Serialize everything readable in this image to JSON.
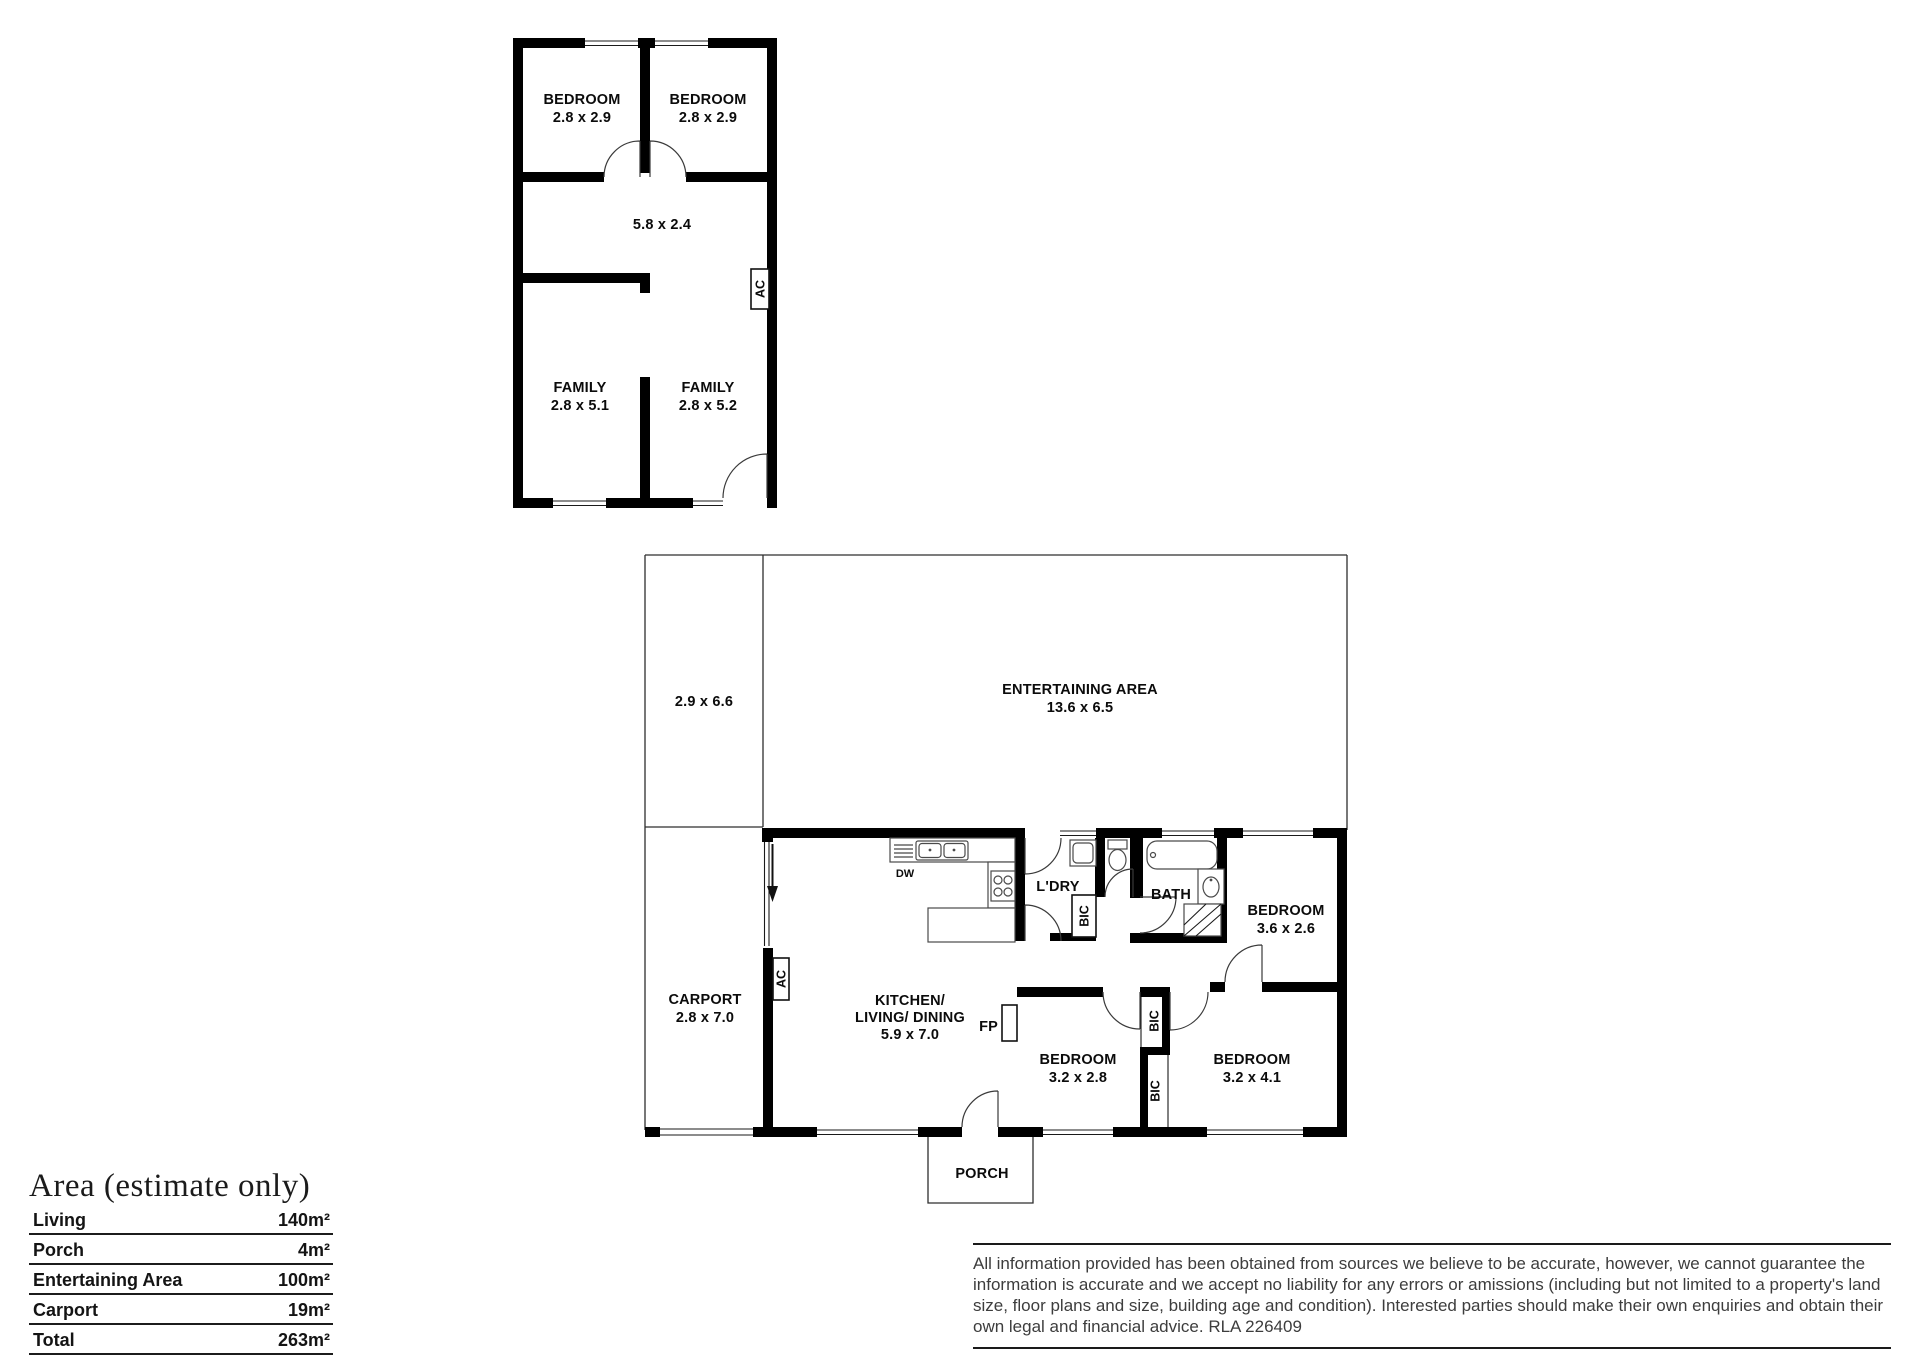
{
  "outbuilding": {
    "bedroom1": {
      "name": "BEDROOM",
      "dims": "2.8 x 2.9"
    },
    "bedroom2": {
      "name": "BEDROOM",
      "dims": "2.8 x 2.9"
    },
    "hall_dims": "5.8 x 2.4",
    "family1": {
      "name": "FAMILY",
      "dims": "2.8 x 5.1"
    },
    "family2": {
      "name": "FAMILY",
      "dims": "2.8 x 5.2"
    },
    "ac": "AC"
  },
  "house": {
    "left_area_dims": "2.9 x 6.6",
    "entertaining": {
      "name": "ENTERTAINING AREA",
      "dims": "13.6 x 6.5"
    },
    "carport": {
      "name": "CARPORT",
      "dims": "2.8 x 7.0"
    },
    "kitchen": {
      "name1": "KITCHEN/",
      "name2": "LIVING/ DINING",
      "dims": "5.9 x 7.0"
    },
    "laundry": "L'DRY",
    "bath": "BATH",
    "bedroom_top": {
      "name": "BEDROOM",
      "dims": "3.6 x 2.6"
    },
    "bedroom_mid": {
      "name": "BEDROOM",
      "dims": "3.2 x 2.8"
    },
    "bedroom_right": {
      "name": "BEDROOM",
      "dims": "3.2 x 4.1"
    },
    "porch": "PORCH",
    "labels": {
      "dw": "DW",
      "fp": "FP",
      "ac": "AC",
      "bic": "BIC"
    }
  },
  "area_table": {
    "title": "Area (estimate only)",
    "rows": [
      {
        "label": "Living",
        "value": "140m²"
      },
      {
        "label": "Porch",
        "value": "4m²"
      },
      {
        "label": "Entertaining Area",
        "value": "100m²"
      },
      {
        "label": "Carport",
        "value": "19m²"
      },
      {
        "label": "Total",
        "value": "263m²"
      }
    ]
  },
  "disclaimer": {
    "text": "All information provided has been obtained from sources we believe to be accurate, however, we cannot guarantee the information is accurate and we accept no liability for any errors or amissions (including but not limited to a property's land size, floor plans and size, building age and condition). Interested parties should make their own enquiries and obtain their own legal and financial advice. RLA 226409"
  }
}
